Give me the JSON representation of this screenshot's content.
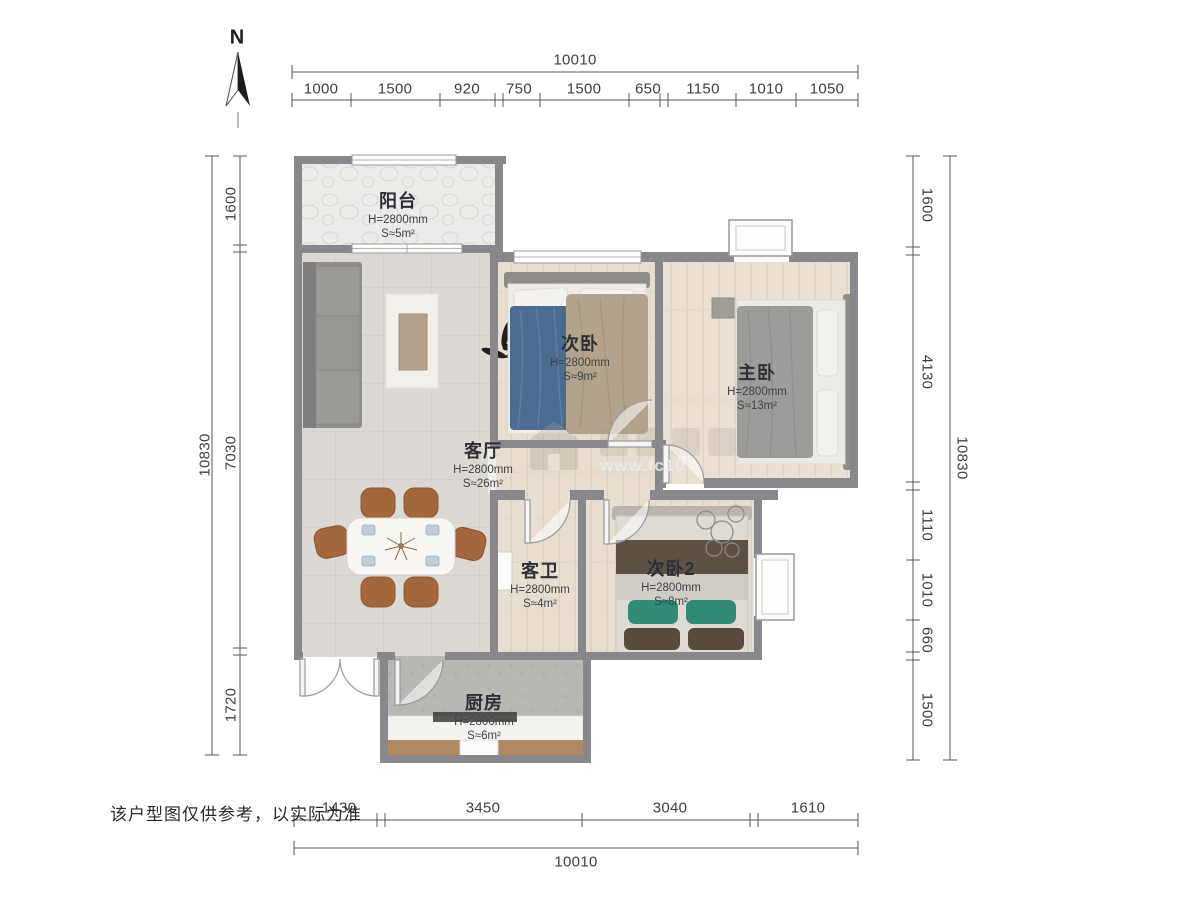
{
  "north": {
    "label": "N"
  },
  "footer": {
    "disclaimer": "该户型图仅供参考，以实际为准"
  },
  "watermark": {
    "url_text": "www.fc10"
  },
  "dimensions": {
    "top": {
      "total": "10010",
      "segments": [
        "1000",
        "1500",
        "920",
        "750",
        "1500",
        "650",
        "1150",
        "1010",
        "1050"
      ]
    },
    "bottom": {
      "total": "10010",
      "segments": [
        "1430",
        "3450",
        "3040",
        "1610"
      ]
    },
    "left": {
      "total": "10830",
      "segments": [
        "1600",
        "7030",
        "1720"
      ]
    },
    "right": {
      "total": "10830",
      "segments": [
        "1600",
        "4130",
        "1110",
        "1010",
        "660",
        "1500"
      ]
    }
  },
  "rooms": [
    {
      "id": "balcony",
      "name": "阳台",
      "height": "H=2800mm",
      "area": "S≈5m²"
    },
    {
      "id": "bedroom2",
      "name": "次卧",
      "height": "H=2800mm",
      "area": "S≈9m²"
    },
    {
      "id": "master",
      "name": "主卧",
      "height": "H=2800mm",
      "area": "S≈13m²"
    },
    {
      "id": "living",
      "name": "客厅",
      "height": "H=2800mm",
      "area": "S≈26m²"
    },
    {
      "id": "bath",
      "name": "客卫",
      "height": "H=2800mm",
      "area": "S≈4m²"
    },
    {
      "id": "bedroom3",
      "name": "次卧2",
      "height": "H=2800mm",
      "area": "S≈8m²"
    },
    {
      "id": "kitchen",
      "name": "厨房",
      "height": "H=2800mm",
      "area": "S≈6m²"
    }
  ],
  "colors": {
    "wall": "#87878c",
    "wood": "#e7ddd0",
    "tile": "#dcd9d4",
    "stone": "#ecebe9",
    "kitchen_floor": "#b9b8b5",
    "sofa": "#90908e",
    "chair": "#a2673c",
    "blanket_blue": "#4b6c91",
    "blanket_tan": "#b3a28c",
    "blanket_gray": "#9c9c9a",
    "pillow_teal": "#2f8b74",
    "blanket_brown": "#5d5146",
    "dim_text": "#3b3f46"
  }
}
